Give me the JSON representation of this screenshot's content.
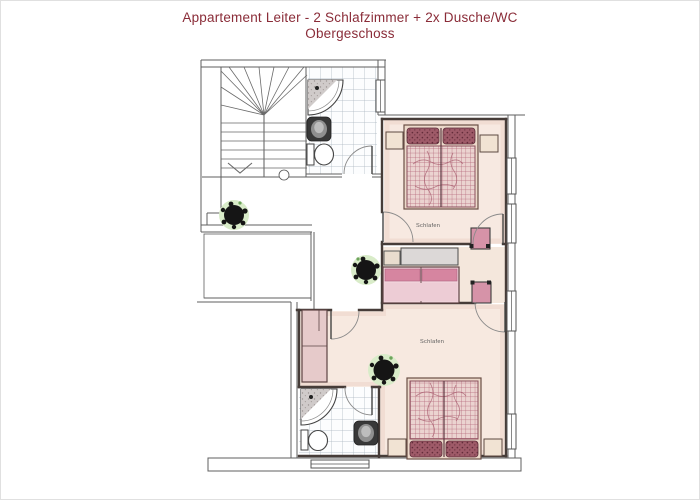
{
  "page": {
    "background": "#ffffff",
    "border": "#e0e0e0"
  },
  "title": {
    "line1": "Appartement Leiter - 2 Schlafzimmer + 2x Dusche/WC",
    "line2": "Obergeschoss",
    "color": "#8a2c38"
  },
  "rooms": {
    "bedroom_upper": {
      "label": "Schlafen"
    },
    "bedroom_lower": {
      "label": "Schlafen"
    }
  },
  "fixtures": [
    "staircase",
    "corner-shower",
    "washbasin",
    "toilet",
    "double-bed",
    "pillows",
    "nightstand",
    "wardrobe",
    "dresser",
    "sofa",
    "chair",
    "potted-plant",
    "window",
    "door-swing"
  ],
  "colors": {
    "wall_heavy": "#463c38",
    "wall_light": "#5f5f5f",
    "bedroom_floor": "#f7e9e1",
    "duvet_base": "#ebd3d0",
    "duvet_grid": "#b26477",
    "pillow": "#9e5a68",
    "sofa_back": "#d98ca4",
    "sofa_seat": "#f0d2da",
    "furniture_gray": "#dcd8d7",
    "wardrobe": "#e6caca",
    "plant": "#151515",
    "plant_halo": "#d9ecc9",
    "tile_line": "#a8b3bd"
  }
}
